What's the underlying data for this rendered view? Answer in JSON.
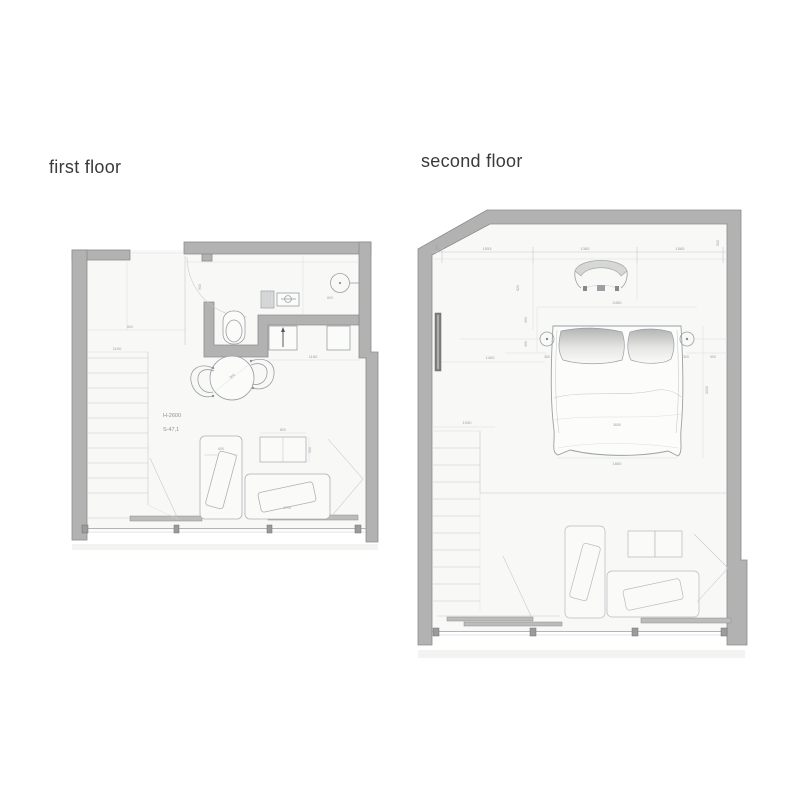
{
  "ff": {
    "title": "first floor",
    "h": "H-2600",
    "s": "S-47,1",
    "d_stair": "1100",
    "d_closet": "600",
    "d_bath": "900",
    "d_shower": "600",
    "d_kitchen": "1160",
    "d_table": "900",
    "d_sidetable_w": "800",
    "d_sidetable_d": "500",
    "d_lounge_v": "600",
    "d_lounge_h": "1700"
  },
  "sf": {
    "title": "second floor",
    "d_top1": "1553",
    "d_top2": "1365",
    "d_top3": "1565",
    "d_top_l": "420",
    "d_top_r": "500",
    "d_shelf": "1400",
    "d_stair": "1030",
    "d_bed_top": "2450",
    "d_bed_w": "1850",
    "d_bed_c": "3650",
    "d_bed_side": "2000",
    "d_gap_l": "360",
    "d_gap_r": "300",
    "d_gap_out": "900",
    "d_v1": "620",
    "d_v2": "200",
    "d_v3": "400"
  },
  "colors": {
    "wall": "#b2b2b2",
    "wall_edge": "#8c8c8c",
    "floor": "#f8f8f7",
    "sketch_line": "#c3c7ca",
    "dark_line": "#9aa0a5",
    "title_text": "#3a3a3a",
    "dim_text": "#9aa0a5",
    "background": "#ffffff"
  }
}
